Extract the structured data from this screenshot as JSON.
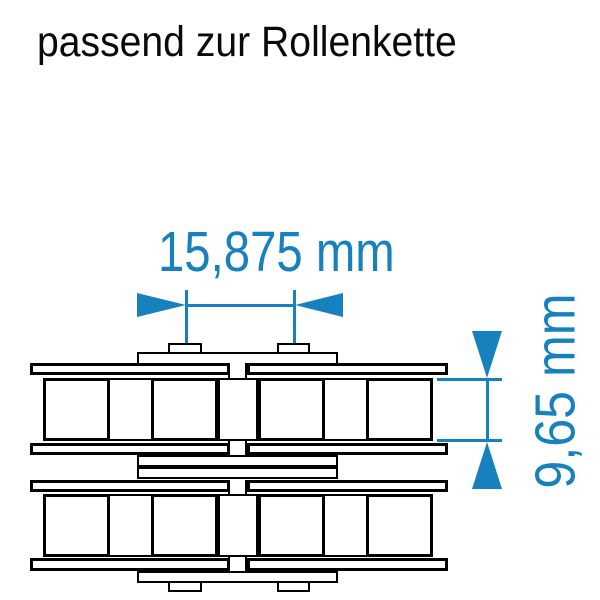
{
  "title": "passend zur Rollenkette",
  "dimensions": {
    "pitch": {
      "label": "15,875 mm",
      "value": "15,875",
      "unit": "mm"
    },
    "inner_width": {
      "label": "9,65 mm",
      "value": "9,65",
      "unit": "mm"
    }
  },
  "drawing": {
    "subject": "double-strand roller chain, side view",
    "strands": 2,
    "rollers_per_strand": 4
  },
  "colors": {
    "dimension_blue": "#1781BE",
    "line_black": "#000000",
    "background": "#FFFFFF"
  }
}
